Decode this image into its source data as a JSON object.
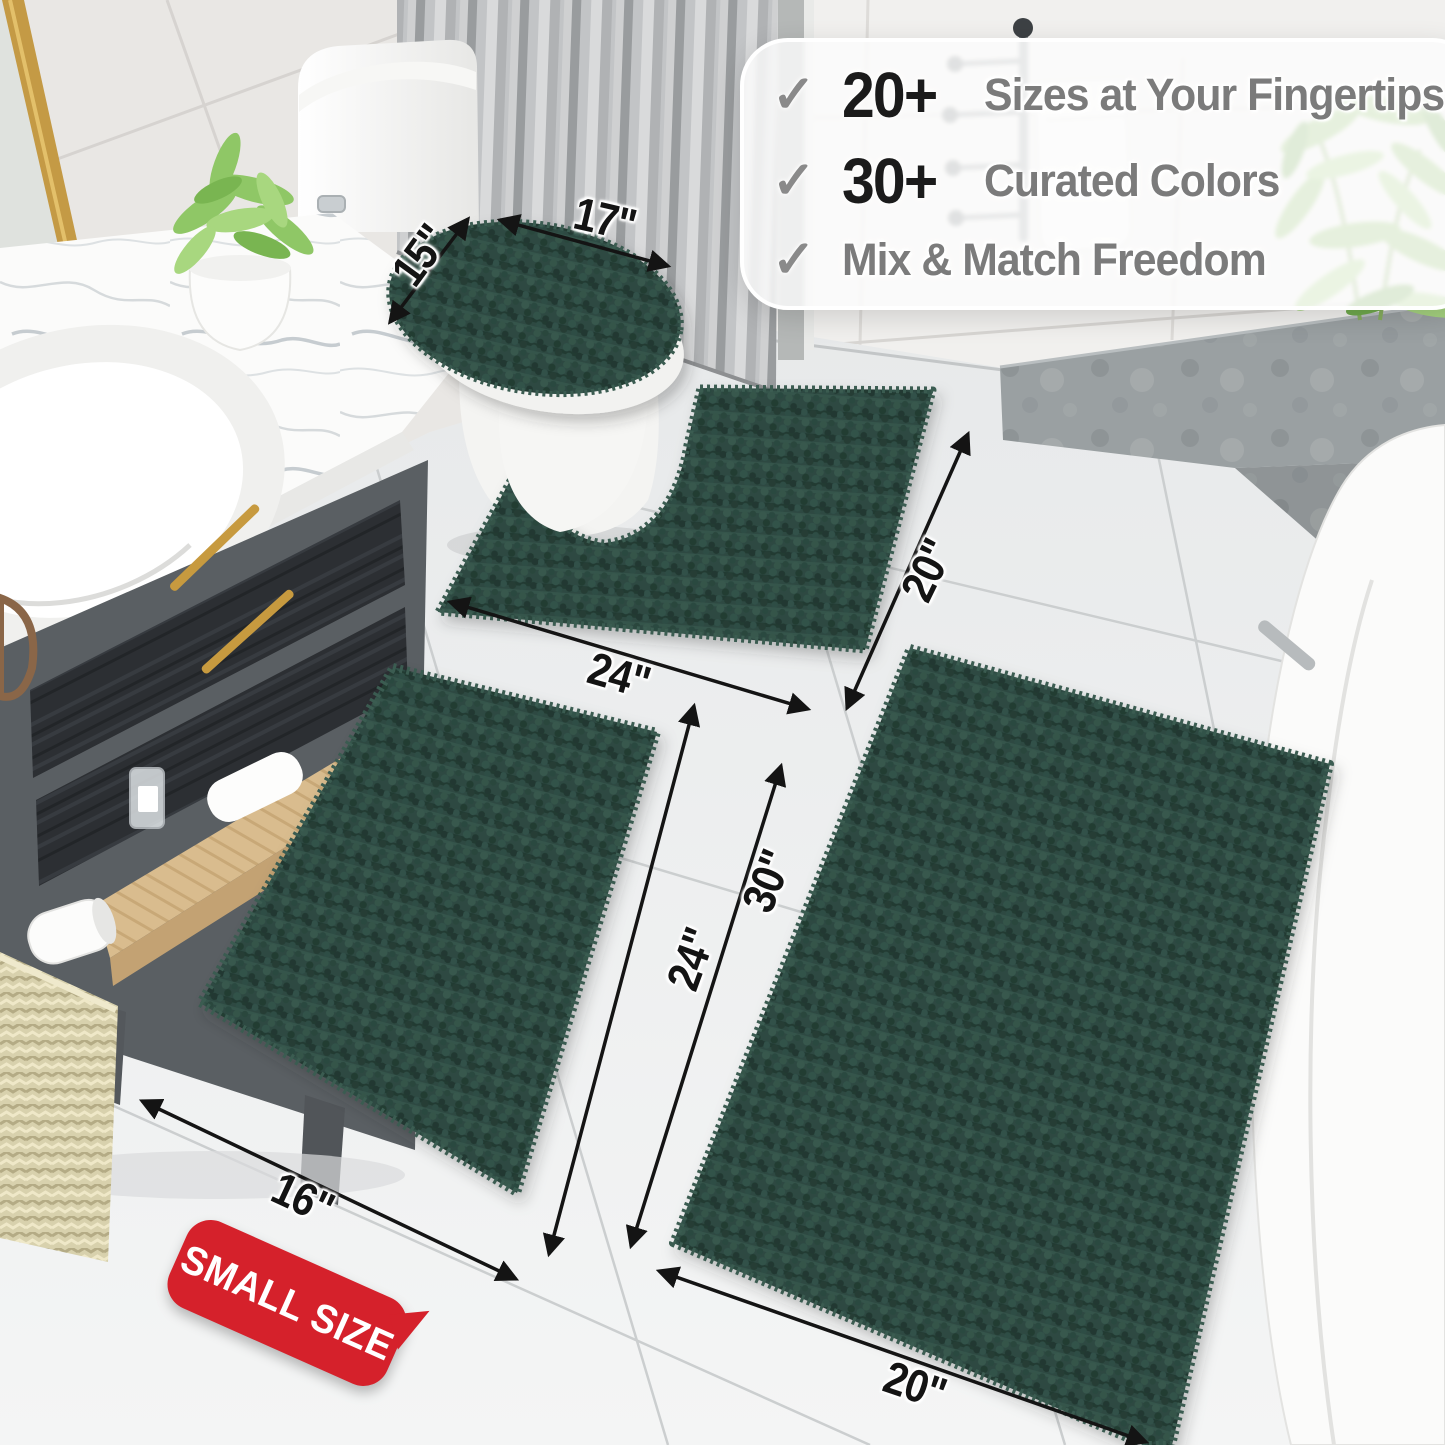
{
  "colors": {
    "rug_green": "#2d4a42",
    "badge_red": "#d5212b",
    "gold_accent": "#c49a45",
    "arrow_black": "#141414"
  },
  "callout": {
    "check_glyph": "✓",
    "items": [
      {
        "stat": "20+",
        "label": "Sizes at Your Fingertips"
      },
      {
        "stat": "30+",
        "label": "Curated Colors"
      },
      {
        "stat": "",
        "label": "Mix & Match Freedom"
      }
    ]
  },
  "dimension_labels": {
    "lid_length": "17\"",
    "lid_width": "15\"",
    "contour_width": "24\"",
    "contour_depth": "20\"",
    "large_rug_length": "30\"",
    "small_rug_length": "24\"",
    "small_rug_width": "16\"",
    "large_rug_width": "20\""
  },
  "badge": {
    "text": "SMALL SIZE"
  }
}
